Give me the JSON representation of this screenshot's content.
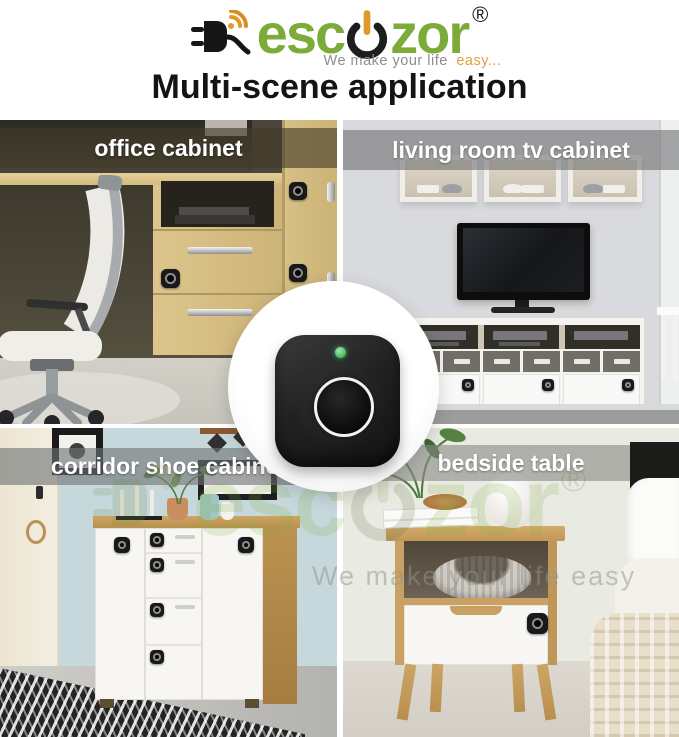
{
  "brand": {
    "logo_text_left": "esc",
    "logo_text_right": "zor",
    "registered_mark": "®",
    "tagline_gray": "We make your life",
    "tagline_accent": "easy...",
    "colors": {
      "green": "#7dab39",
      "orange": "#e2992b",
      "dark": "#1c1c1c"
    }
  },
  "title": "Multi-scene application",
  "scenes": [
    {
      "id": "office-cabinet",
      "label": "office cabinet"
    },
    {
      "id": "living-room-tv-cabinet",
      "label": "living room tv cabinet"
    },
    {
      "id": "corridor-shoe-cabinet",
      "label": "corridor shoe cabinet"
    },
    {
      "id": "bedside-table",
      "label": "bedside table"
    }
  ],
  "product": {
    "led_color": "#43b95c"
  },
  "watermark": {
    "text_left": "esc",
    "text_right": "zor",
    "registered_mark": "®",
    "tagline": "We make your life easy"
  },
  "icons": {
    "plug-wifi-icon": "black power plug emitting orange wireless arcs",
    "power-button-icon": "power symbol forming the letter o",
    "led-indicator": "green status dot",
    "fingerprint-sensor": "round sensor with silver ring",
    "cabinet-lock-device": "black rounded smart lock pad"
  }
}
